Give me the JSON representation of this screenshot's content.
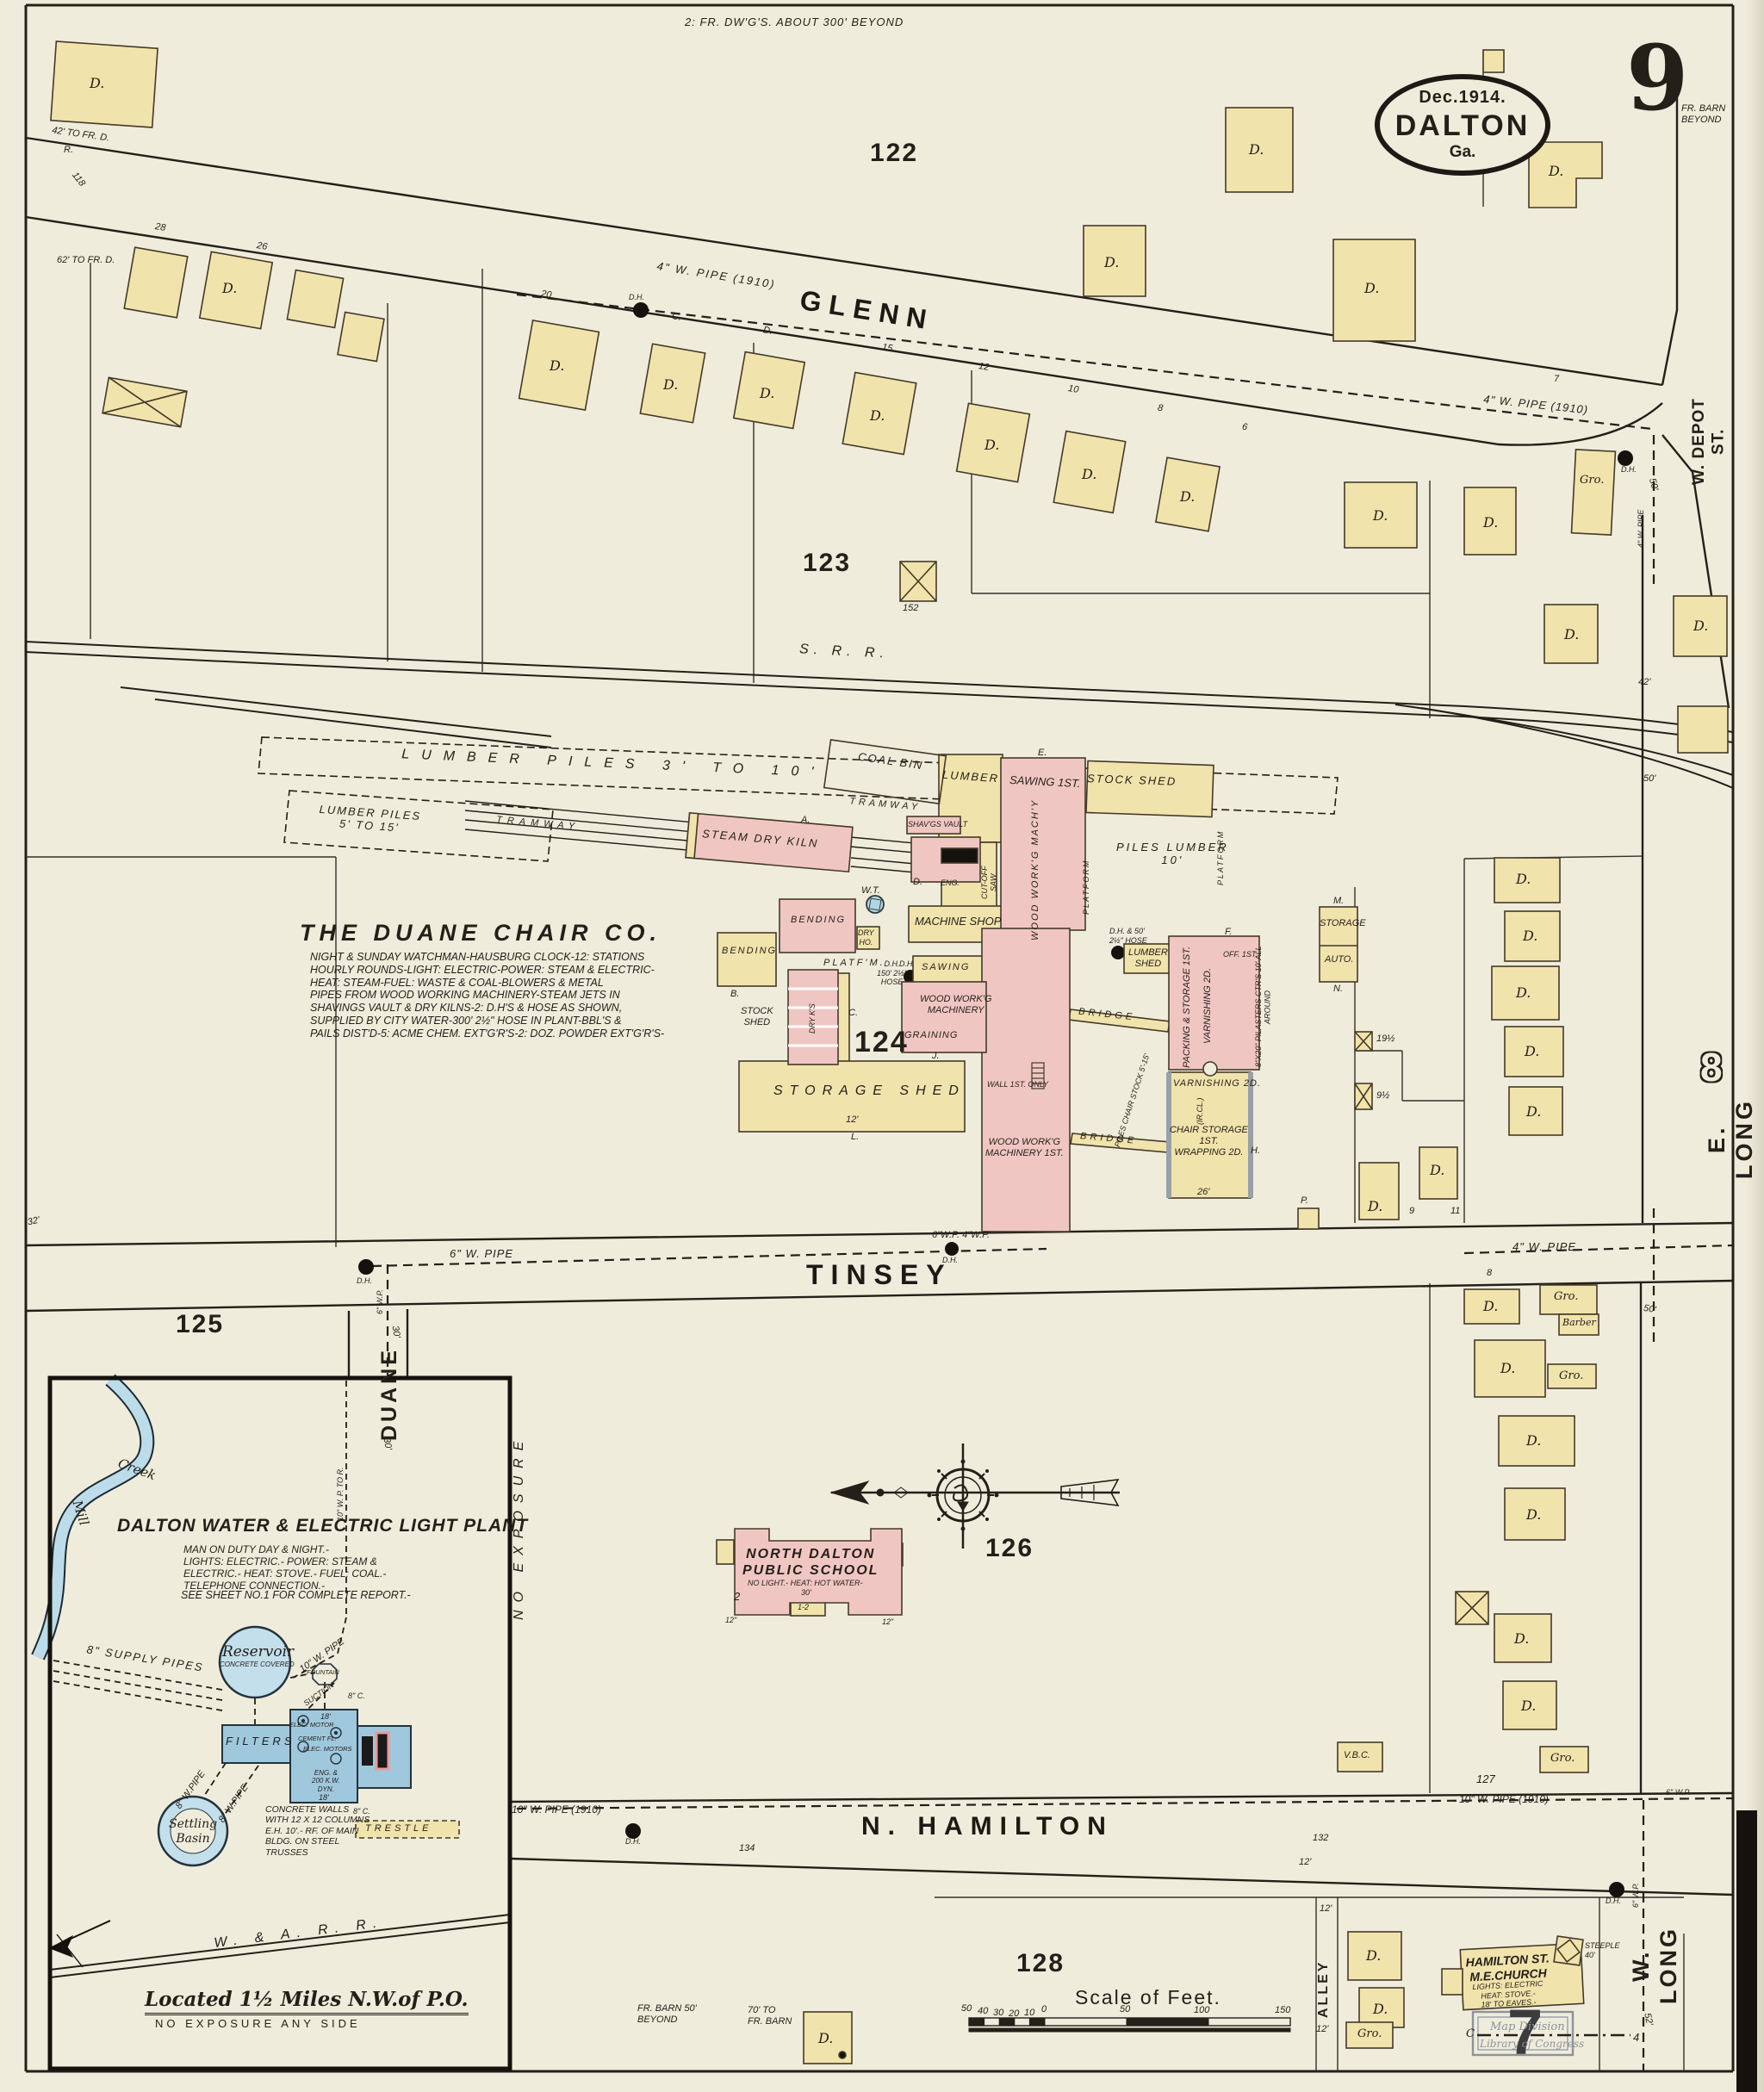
{
  "page": {
    "big9": "9",
    "sheet8": "8",
    "sheet7": "7",
    "top_note": "2: FR. DW'G'S. ABOUT 300' BEYOND",
    "fr_barn": "FR. BARN\nBEYOND",
    "date": "Dec.1914.",
    "city": "DALTON",
    "state": "Ga."
  },
  "streets": {
    "glenn": "GLENN",
    "tinsey": "TINSEY",
    "hamilton": "N. HAMILTON",
    "e_long": "E. LONG",
    "w_long": "W. LONG",
    "w_depot": "W. DEPOT ST.",
    "duane": "DUANE",
    "alley": "ALLEY",
    "srr": "S. R. R.",
    "warr": "W. & A. R. R.",
    "no_exposure": "NO EXPOSURE"
  },
  "blocks": {
    "n122": "122",
    "n123": "123",
    "n124": "124",
    "n125": "125",
    "n126": "126",
    "n127": "127",
    "n128": "128"
  },
  "chairco": {
    "title": "THE DUANE CHAIR CO.",
    "report": "NIGHT & SUNDAY WATCHMAN-HAUSBURG CLOCK-12: STATIONS\nHOURLY ROUNDS-LIGHT: ELECTRIC-POWER: STEAM & ELECTRIC-\nHEAT: STEAM-FUEL: WASTE & COAL-BLOWERS & METAL\nPIPES FROM WOOD WORKING MACHINERY-STEAM JETS IN\nSHAVINGS VAULT & DRY KILNS-2: D.H'S & HOSE AS SHOWN,\nSUPPLIED BY CITY WATER-300' 2½\" HOSE IN PLANT-BBL'S &\nPAILS DIST'D-5: ACME CHEM. EXT'G'R'S-2: DOZ. POWDER EXT'G'R'S-"
  },
  "factory": {
    "coal_bin": "COAL BIN",
    "lumber": "LUMBER",
    "sawing1": "SAWING 1ST.",
    "stock_shed": "STOCK SHED",
    "kiln": "STEAM DRY KILN",
    "tramway": "TRAMWAY",
    "piles_big": "LUMBER PILES 3' TO 10'",
    "piles_small": "LUMBER PILES\n5' TO 15'",
    "piles_lumber": "PILES LUMBER\n10'",
    "machine_shop": "MACHINE SHOP",
    "shavings": "SHAV'GS VAULT",
    "eng": "ENG.",
    "wwm_v": "WOOD WORK'G MACH'Y",
    "bending": "BENDING",
    "dry_ho": "DRY\nHO.",
    "platform": "PLATFORM",
    "platfm": "PLATF'M.",
    "stock_shed2": "STOCK\nSHED",
    "dry_ks": "DRY K'S",
    "graining": "GRAINING",
    "wwm2": "WOOD WORK'G\nMACHINERY",
    "sawing2": "SAWING",
    "storage_shed": "STORAGE SHED",
    "wwm1st": "WOOD WORK'G\nMACHINERY 1ST.",
    "bridge": "BRIDGE",
    "chair_stock": "PILES CHAIR STOCK 5'-15'",
    "packing": "PACKING & STORAGE 1ST.",
    "varnishing_v": "VARNISHING 2D.",
    "off": "OFF. 1ST.",
    "pilasters": "8\"X20\" PILASTERS CTR'S 10' ALL AROUND",
    "varnishing2": "VARNISHING 2D.",
    "ircl": "(IR.CL.)",
    "chair_storage": "CHAIR STORAGE\n1ST.\nWRAPPING 2D.",
    "lumber_shed": "LUMBER\nSHED",
    "wt": "W.T.",
    "dh_hose_a": "D.H. & 50'\n2½\" HOSE",
    "dh_hose_b": "D.H.\n150' 2½\"\nHOSE",
    "storage": "STORAGE",
    "auto": "AUTO.",
    "wall_note": "WALL 1ST. ONLY",
    "cutoff": "CUT-OFF\nSAW",
    "lA": "A.",
    "lB": "B.",
    "lC": "C.",
    "lD": "D.",
    "lE": "E.",
    "lF": "F.",
    "lH": "H.",
    "lJ": "J.",
    "lL": "L.",
    "lM": "M.",
    "lN": "N.",
    "lP": "P."
  },
  "school": {
    "name": "NORTH DALTON\nPUBLIC SCHOOL",
    "note": "NO LIGHT.- HEAT: HOT WATER-",
    "w30": "30'",
    "s2": "2",
    "s12": "1-2",
    "in12": "12\""
  },
  "church": {
    "name": "HAMILTON ST.\nM.E.CHURCH",
    "note": "LIGHTS: ELECTRIC\nHEAT: STOVE.-\n18' TO EAVES.-",
    "steeple": "STEEPLE\n40'"
  },
  "plant": {
    "title": "DALTON WATER & ELECTRIC LIGHT PLANT",
    "report": "MAN ON DUTY DAY & NIGHT.-\nLIGHTS: ELECTRIC.- POWER: STEAM &\nELECTRIC.- HEAT: STOVE.- FUEL: COAL.-\nTELEPHONE CONNECTION.-",
    "see": "SEE SHEET NO.1 FOR COMPLETE REPORT.-",
    "reservoir": "Reservoir",
    "res_note": "CONCRETE COVERED",
    "filters": "FILTERS",
    "settling": "Settling\nBasin",
    "supply": "8\" SUPPLY PIPES",
    "w10pipe": "10\" W. PIPE",
    "w10tor": "10\" W. P. TO R.",
    "w8pipe": "8\" W.PIPE",
    "fountain": "FOUNTAIN",
    "suction": "SUCTION",
    "concrete": "CONCRETE WALLS\nWITH 12 X 12 COLUMNS\nE.H. 10'.- RF. OF MAIN\nBLDG. ON STEEL\nTRUSSES",
    "trestle": "TRESTLE",
    "c8": "8\" C.",
    "eng": "ENG. &\n200 K.W.\nDYN.",
    "elec_motor": "ELEC. MOTOR",
    "cement": "CEMENT FL.",
    "elec_motors": "ELEC. MOTORS",
    "d18": "18'",
    "mill": "Mill",
    "creek": "Creek",
    "located": "Located 1½ Miles N.W.of P.O.",
    "no_exp": "NO EXPOSURE ANY SIDE"
  },
  "pipes": {
    "glenn": "4\" W. PIPE (1910)",
    "glenn2": "4\" W. PIPE (1910)",
    "tinsey6": "6\" W. PIPE",
    "tinsey64": "6\"W.P.  4\"W.P.",
    "tinsey4": "4\" W. PIPE",
    "duane6": "6\" W.P.",
    "ham10a": "10\" W. PIPE (1910)",
    "ham10b": "10\" W. PIPE (1910)",
    "wlong6": "6\" W.P.",
    "vert4": "4\" W. PIPE",
    "dh": "D.H."
  },
  "marks": {
    "dwelling": "D.",
    "grocery": "Gro.",
    "barber": "Barber",
    "n20": "20",
    "n15": "15",
    "n12": "12",
    "n10": "10",
    "n8": "8",
    "n6": "6",
    "n7": "7",
    "n28": "28",
    "n26": "26",
    "c": "C.",
    "n152": "152",
    "f42": "42' TO FR. D.",
    "f62": "62' TO FR. D.",
    "r": "R.",
    "n118": "118",
    "f50": "50'",
    "f42b": "42'",
    "f32": "32'",
    "f52": "52'",
    "thirty": "30'",
    "twelve": "12'",
    "n134": "134",
    "n132": "132",
    "n19h": "19½",
    "n9h": "9½",
    "vbc": "V.B.C.",
    "c4": "4",
    "cC": "C",
    "fr_barn50": "FR. BARN 50'\nBEYOND",
    "fr_barn70": "70' TO\nFR. BARN",
    "n9": "9",
    "n11": "11",
    "n26f": "26'"
  },
  "scale": {
    "title": "Scale of Feet.",
    "t50": "50",
    "t40": "40",
    "t30": "30",
    "t20": "20",
    "t10": "10",
    "t0": "0",
    "t50b": "50",
    "t100": "100",
    "t150": "150"
  },
  "stamp": {
    "l1": "Map Division",
    "l2": "Library of Congress"
  }
}
